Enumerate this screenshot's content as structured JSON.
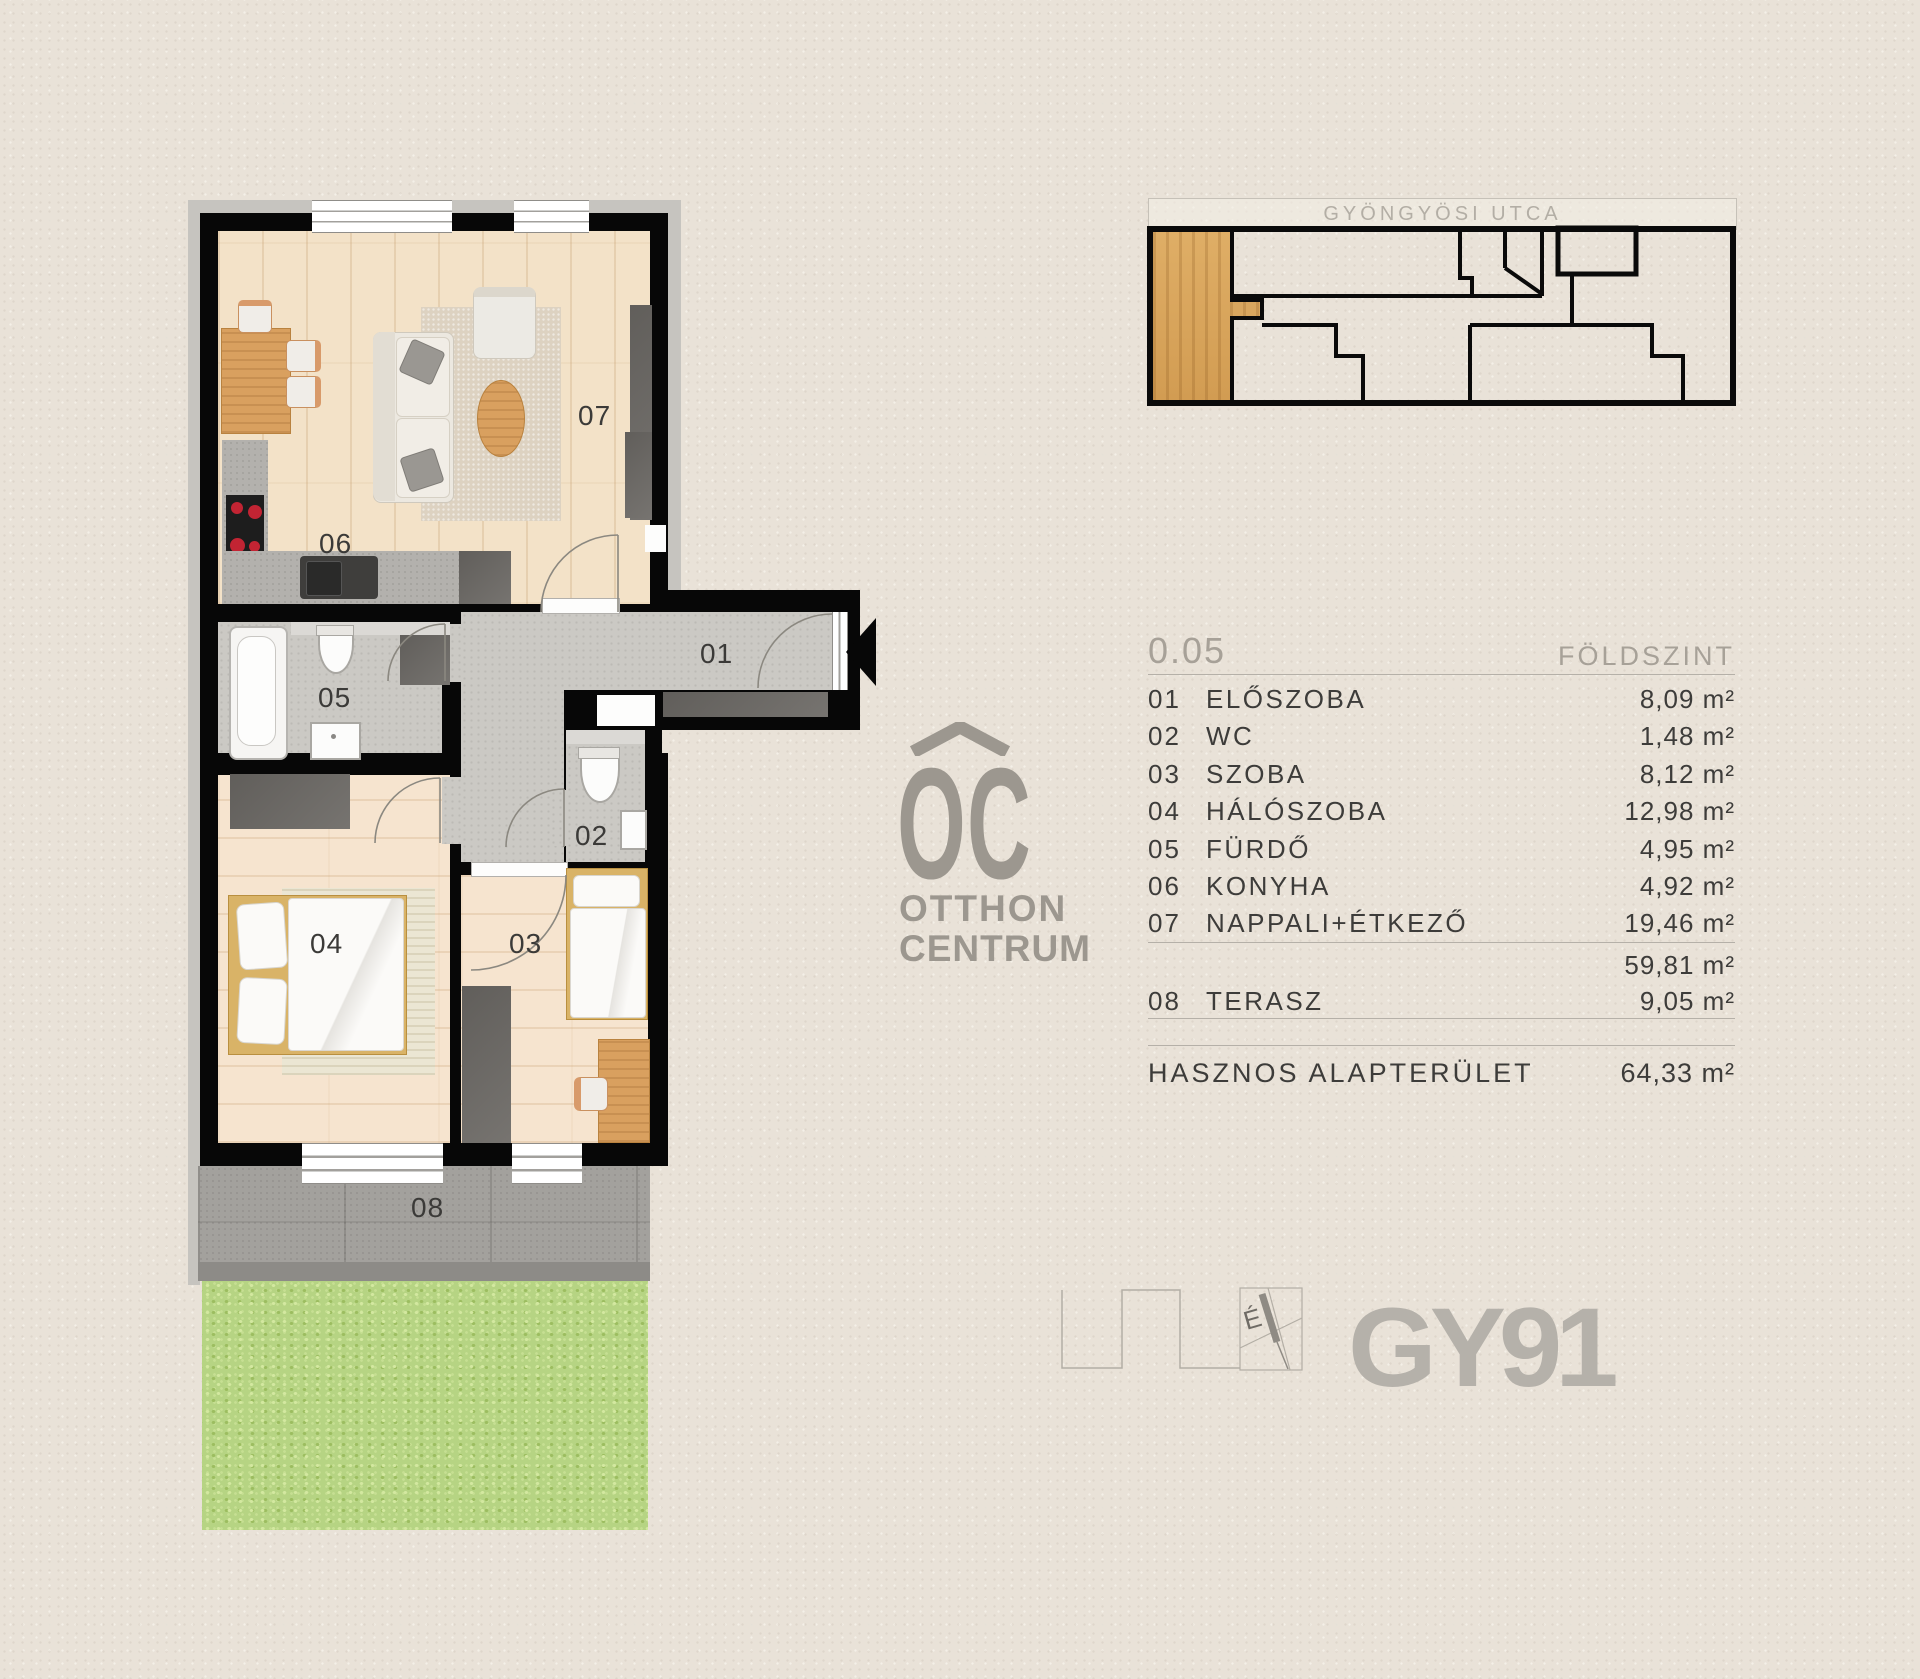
{
  "site": {
    "street": "GYÖNGYÖSI UTCA"
  },
  "unit": {
    "number": "0.05",
    "floor_label": "FÖLDSZINT"
  },
  "table": {
    "rows": [
      {
        "code": "01",
        "name": "ELŐSZOBA",
        "area": "8,09 m²"
      },
      {
        "code": "02",
        "name": "WC",
        "area": "1,48 m²"
      },
      {
        "code": "03",
        "name": "SZOBA",
        "area": "8,12 m²"
      },
      {
        "code": "04",
        "name": "HÁLÓSZOBA",
        "area": "12,98 m²"
      },
      {
        "code": "05",
        "name": "FÜRDŐ",
        "area": "4,95 m²"
      },
      {
        "code": "06",
        "name": "KONYHA",
        "area": "4,92 m²"
      },
      {
        "code": "07",
        "name": "NAPPALI+ÉTKEZŐ",
        "area": "19,46 m²"
      }
    ],
    "subtotal_area": "59,81 m²",
    "terrace": {
      "code": "08",
      "name": "TERASZ",
      "area": "9,05 m²"
    },
    "total_label": "HASZNOS ALAPTERÜLET",
    "total_area": "64,33 m²"
  },
  "plan": {
    "k01": "01",
    "k02": "02",
    "k03": "03",
    "k04": "04",
    "k05": "05",
    "k06": "06",
    "k07": "07",
    "k08": "08"
  },
  "brand": {
    "oc": "OC",
    "line1": "OTTHON",
    "line2": "CENTRUM",
    "project": "GY91",
    "north": "É"
  },
  "colors": {
    "wall": "#070707",
    "wood_floor": "#f3e2c8",
    "bedroom_floor": "#f6e4cf",
    "tile_floor": "#cbc9c4",
    "terrace": "#a3a19d",
    "grass": "#b6d483",
    "highlight_unit_wood": "#d9a75f",
    "logo_gray": "#9c978f",
    "text_dark": "#3d3c3a",
    "text_muted": "#a7a198"
  }
}
